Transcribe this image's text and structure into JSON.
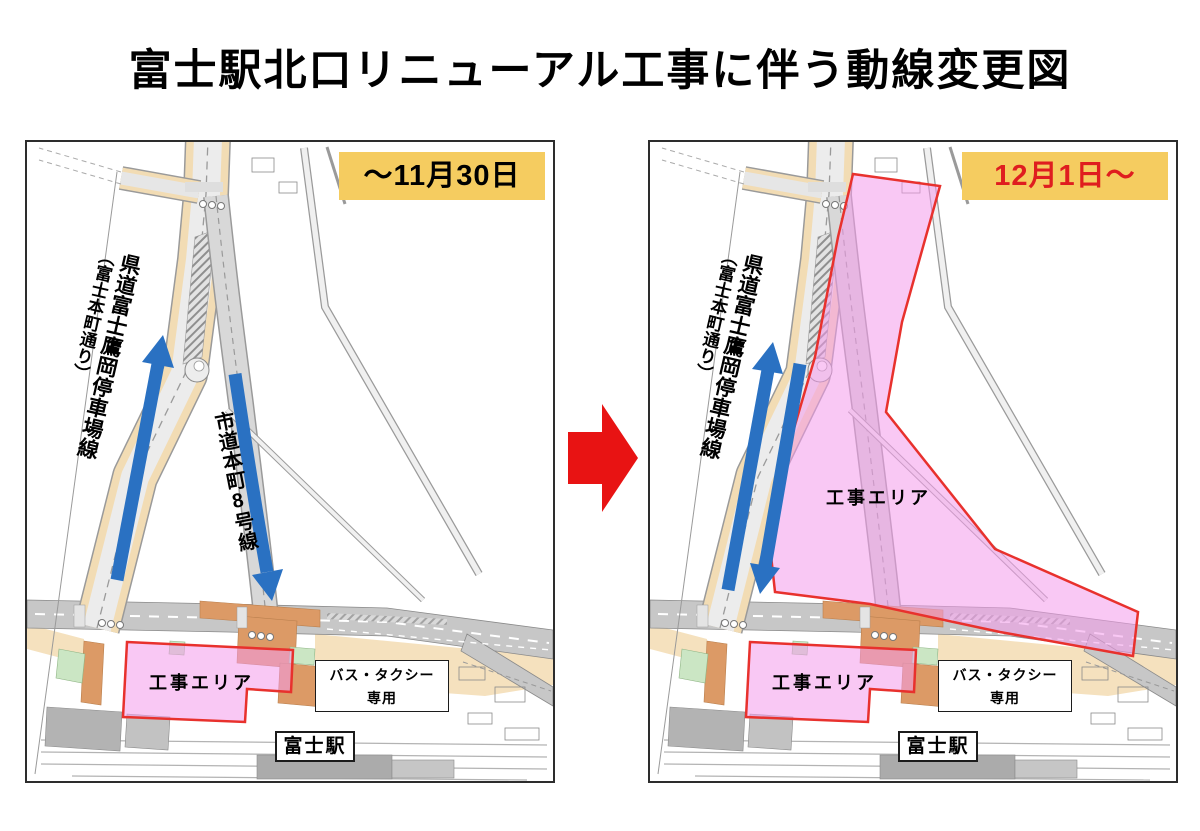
{
  "title": "富士駅北口リニューアル工事に伴う動線変更図",
  "colors": {
    "badge_bg": "#F5CC60",
    "badge_text_before": "#000000",
    "badge_text_after": "#DF1D1F",
    "flow_arrow_blue": "#2A71C2",
    "transition_arrow_red": "#E81313",
    "construction_fill_pink": "#F49AEB",
    "construction_border_red": "#E8312D",
    "road_edge_beige": "#F2DCB4",
    "plaza_orange": "#DC9A66",
    "green_area": "#CBE6C4"
  },
  "transition": {
    "icon": "right-block-arrow"
  },
  "panels": {
    "before": {
      "period_label": "～11月30日",
      "pref_road_name": "県道富士鷹岡停車場線",
      "pref_road_alias": "（富士本町通り）",
      "city_road_name": "市道本町8号線",
      "construction_label": "工事エリア",
      "bus_taxi_line1": "バス・タクシー",
      "bus_taxi_line2": "専用",
      "station_label": "富士駅"
    },
    "after": {
      "period_label": "12月1日～",
      "pref_road_name": "県道富士鷹岡停車場線",
      "pref_road_alias": "（富士本町通り）",
      "construction_label_main": "工事エリア",
      "construction_label_south": "工事エリア",
      "bus_taxi_line1": "バス・タクシー",
      "bus_taxi_line2": "専用",
      "station_label": "富士駅"
    }
  }
}
